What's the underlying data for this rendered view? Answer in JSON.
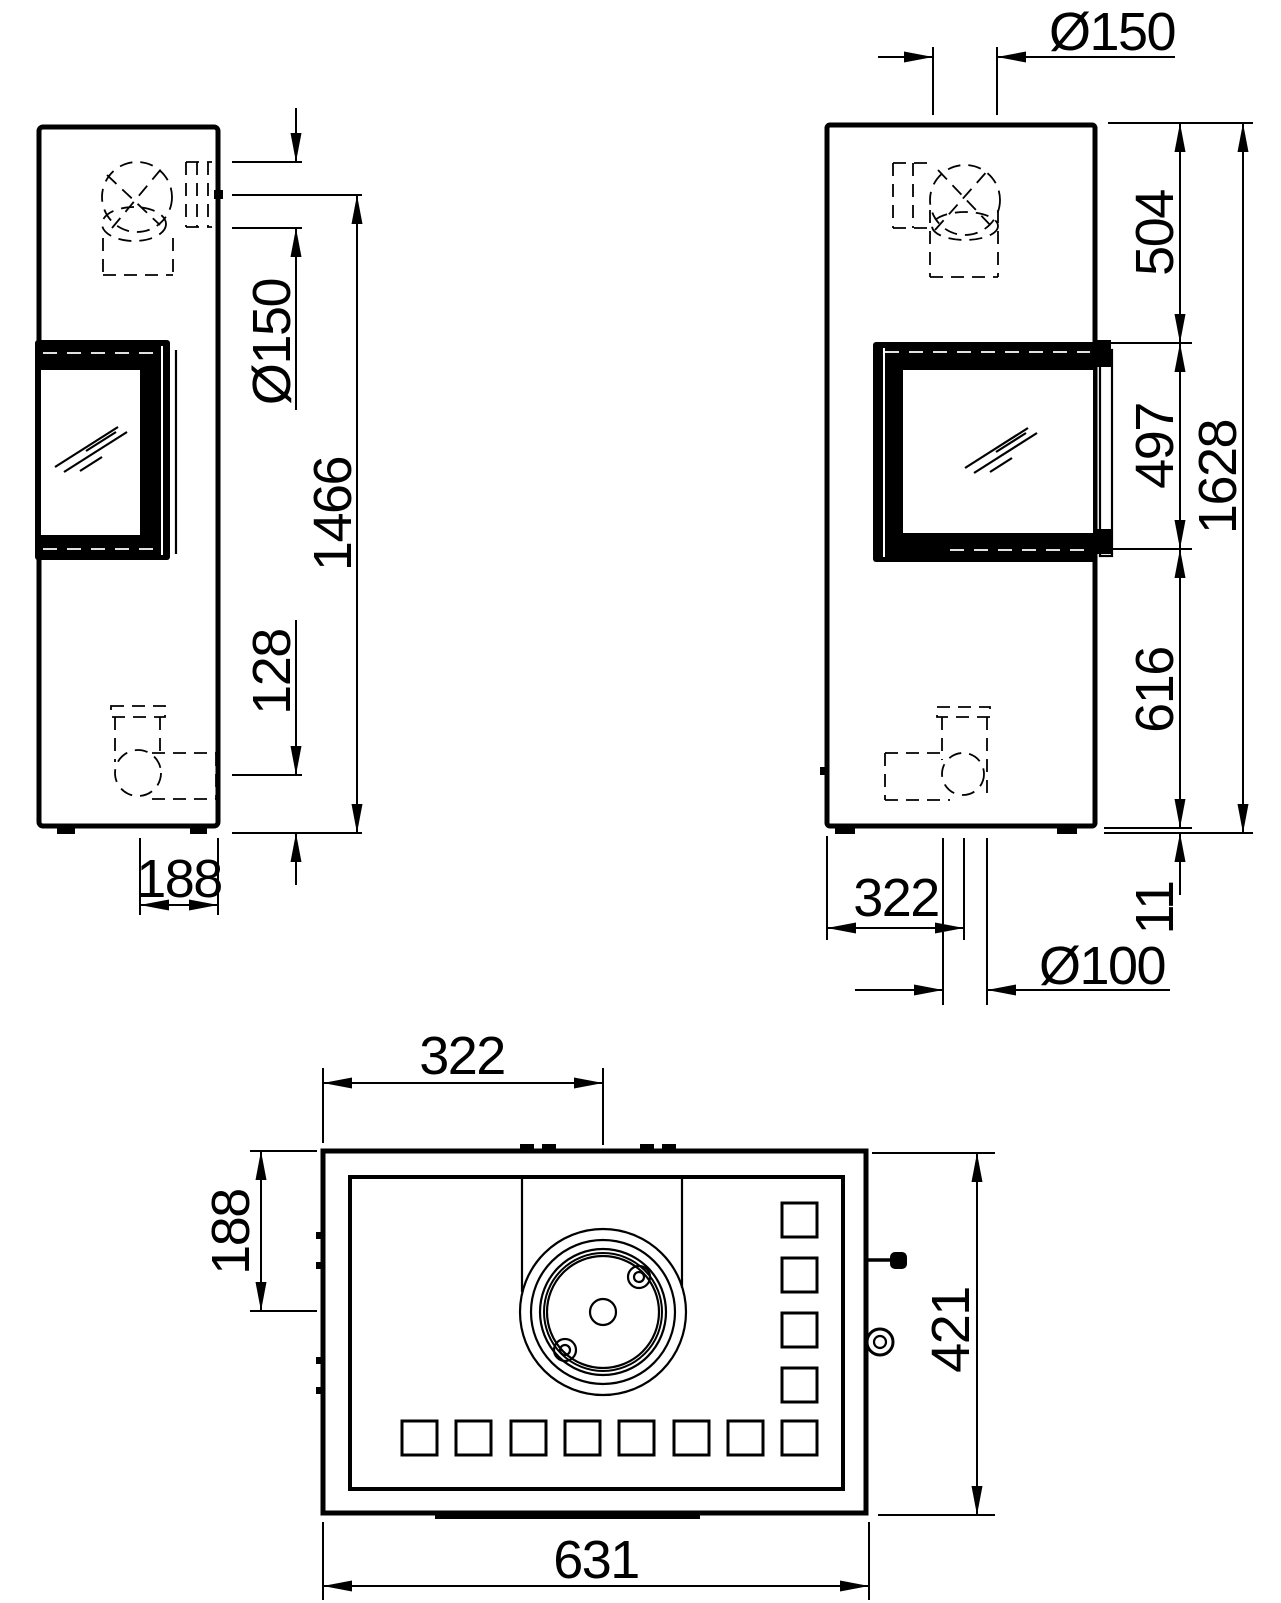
{
  "drawing": {
    "type": "stove-dimension-drawing",
    "background": "#ffffff",
    "line_color": "#000000",
    "views": {
      "side": {
        "label": "side view",
        "dims": {
          "flue_diameter": "Ø150",
          "flue_center_height": "1466",
          "air_inlet_center_height": "128",
          "flue_center_from_back": "188"
        }
      },
      "front": {
        "label": "front view",
        "dims": {
          "top_flue_diameter": "Ø150",
          "top_to_window": "504",
          "window_height": "497",
          "total_height": "1628",
          "window_to_bottom": "616",
          "foot_height": "11",
          "flue_center_from_left": "322",
          "air_inlet_diameter": "Ø100"
        }
      },
      "top": {
        "label": "top view",
        "dims": {
          "flue_center_from_left": "322",
          "flue_center_from_back": "188",
          "depth": "421",
          "width": "631"
        }
      }
    }
  }
}
